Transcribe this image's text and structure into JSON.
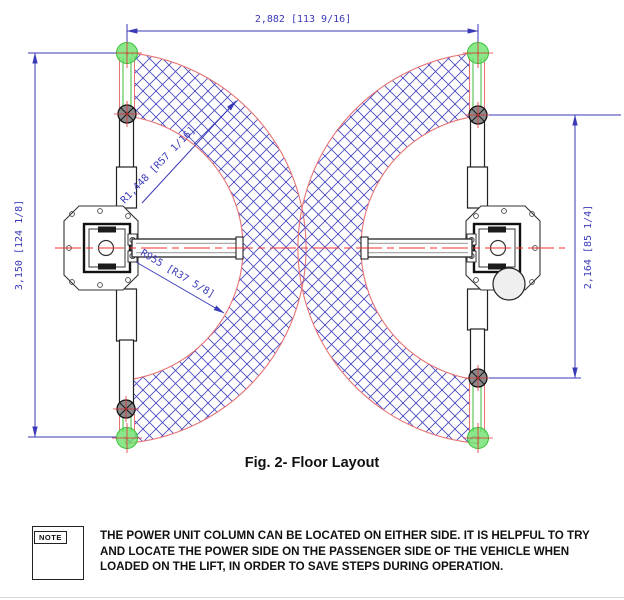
{
  "drawing": {
    "title": "two-post lift floor layout plan view",
    "dimensions": {
      "top_width": "2,882 [113 9/16]",
      "left_height": "3,150 [124 1/8]",
      "right_height": "2,164 [85 1/4]",
      "radius_outer": "R1,448 [R57 1/16]",
      "radius_inner": "R955 [R37 5/8]"
    },
    "colors": {
      "dimension_blue": "#3a3ab8",
      "hatch_blue": "#4949c0",
      "arc_red": "#e87474",
      "centerline_red": "#f03030",
      "marker_green": "#44cc44",
      "pad_gray": "#8a8a8a"
    }
  },
  "caption": "Fig. 2- Floor Layout",
  "note": {
    "label": "NOTE",
    "lines": [
      "THE POWER UNIT COLUMN CAN BE LOCATED ON EITHER SIDE. IT IS HELPFUL TO TRY",
      "AND LOCATE THE POWER SIDE ON THE PASSENGER SIDE OF THE VEHICLE WHEN",
      "LOADED ON THE LIFT, IN ORDER TO SAVE STEPS DURING OPERATION."
    ]
  }
}
